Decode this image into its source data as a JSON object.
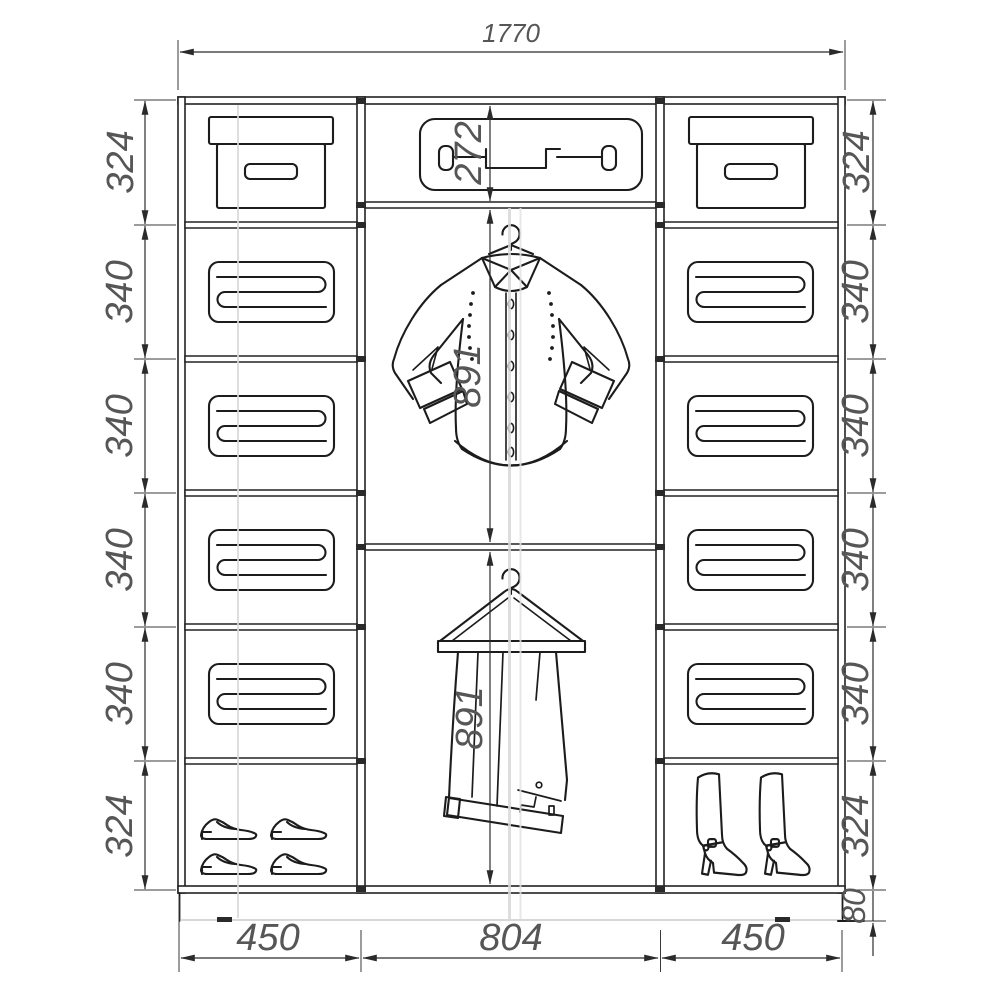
{
  "diagram": {
    "type": "wardrobe-interior-dimension-drawing",
    "units_note": "numbers as printed on drawing"
  },
  "labels": {
    "width_total": "1770",
    "col_left": [
      "324",
      "340",
      "340",
      "340",
      "340",
      "324"
    ],
    "col_right": [
      "324",
      "340",
      "340",
      "340",
      "340",
      "324"
    ],
    "base_height": "80",
    "mid_top": "272",
    "mid_shirt": "891",
    "mid_pants": "891",
    "bottom_widths": [
      "450",
      "804",
      "450"
    ]
  },
  "sections": {
    "left_column": [
      "storage-box",
      "folded-linens",
      "folded-linens",
      "folded-linens",
      "folded-linens",
      "shoes"
    ],
    "middle_column": [
      "suitcase",
      "shirt-on-hanger",
      "trousers-on-hanger"
    ],
    "right_column": [
      "storage-box",
      "folded-linens",
      "folded-linens",
      "folded-linens",
      "folded-linens",
      "boots"
    ]
  },
  "colors": {
    "line": "#1c1c1c",
    "dimension_text": "#565656",
    "background": "#ffffff"
  }
}
